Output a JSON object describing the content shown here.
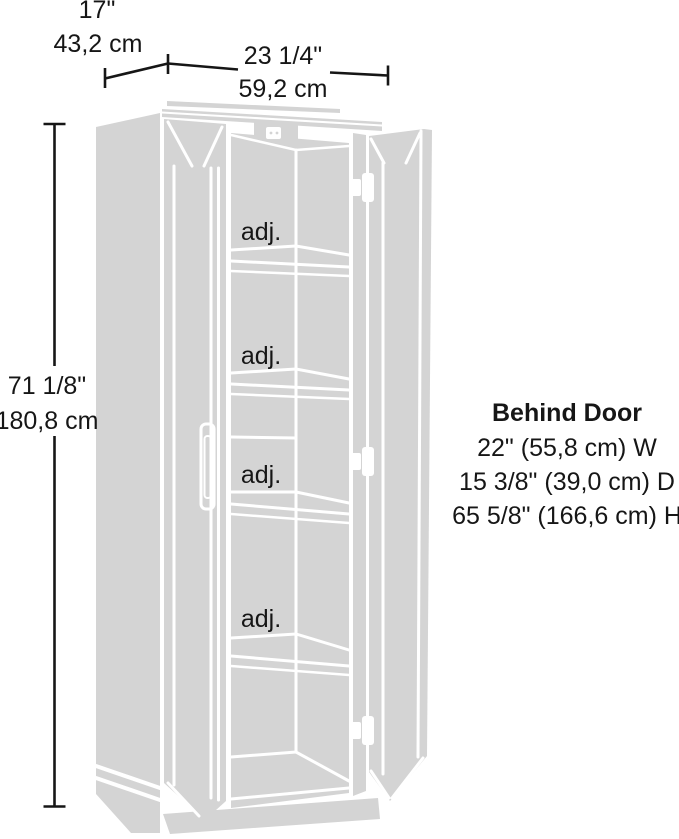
{
  "diagram": {
    "type": "product-dimension-diagram",
    "subject": "tall storage cabinet line drawing with two open doors and adjustable shelves",
    "colors": {
      "background": "#ffffff",
      "art_fill": "#d4d4d4",
      "art_lines": "#ffffff",
      "dimension_lines": "#161616",
      "text": "#161616"
    },
    "dimensions": {
      "depth": {
        "inches": "17\"",
        "cm": "43,2 cm"
      },
      "width": {
        "inches": "23 1/4\"",
        "cm": "59,2 cm"
      },
      "height": {
        "inches": "71 1/8\"",
        "cm": "180,8 cm"
      }
    },
    "behind_door": {
      "title": "Behind Door",
      "width": "22\" (55,8 cm) W",
      "depth": "15 3/8\" (39,0 cm) D",
      "height": "65 5/8\" (166,6 cm) H"
    },
    "shelves": [
      {
        "label": "adj."
      },
      {
        "label": "adj."
      },
      {
        "label": "adj."
      },
      {
        "label": "adj."
      }
    ]
  }
}
